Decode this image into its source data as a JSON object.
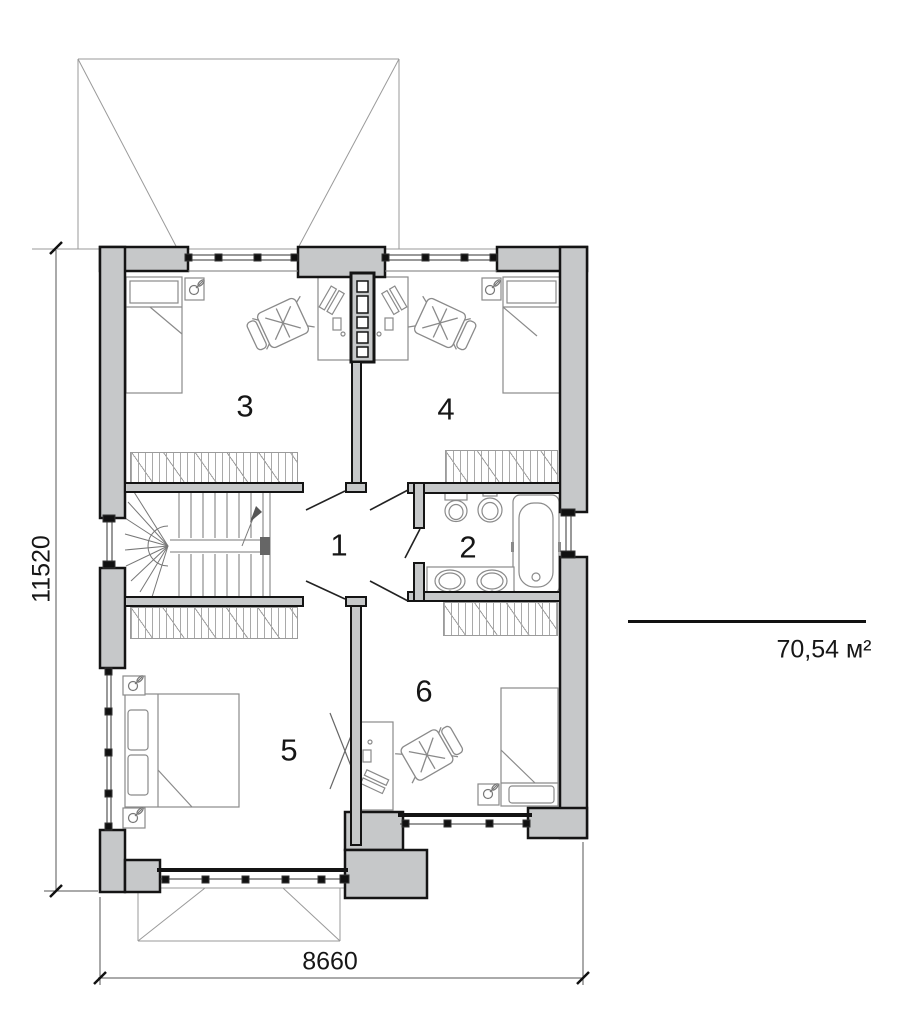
{
  "plan": {
    "rooms": [
      {
        "label": "1"
      },
      {
        "label": "2"
      },
      {
        "label": "3"
      },
      {
        "label": "4"
      },
      {
        "label": "5"
      },
      {
        "label": "6"
      }
    ],
    "dimensions": {
      "vertical": "11520",
      "horizontal": "8660"
    },
    "area": {
      "value": "70,54 м²"
    },
    "colors": {
      "wall_fill": "#c6c8c9",
      "outline": "#141414",
      "furniture_line": "#8a8a8a",
      "roof_line": "#9a9a9a"
    },
    "symbols": [
      "roof-outline",
      "window",
      "door-swing",
      "winder-staircase",
      "wardrobe-hatch",
      "single-bed",
      "double-bed",
      "bedside-table-lamp",
      "desk-with-computer",
      "office-chair",
      "toilet",
      "bidet",
      "bathtub",
      "double-washbasin",
      "dimension-tick",
      "area-divider-line"
    ]
  }
}
